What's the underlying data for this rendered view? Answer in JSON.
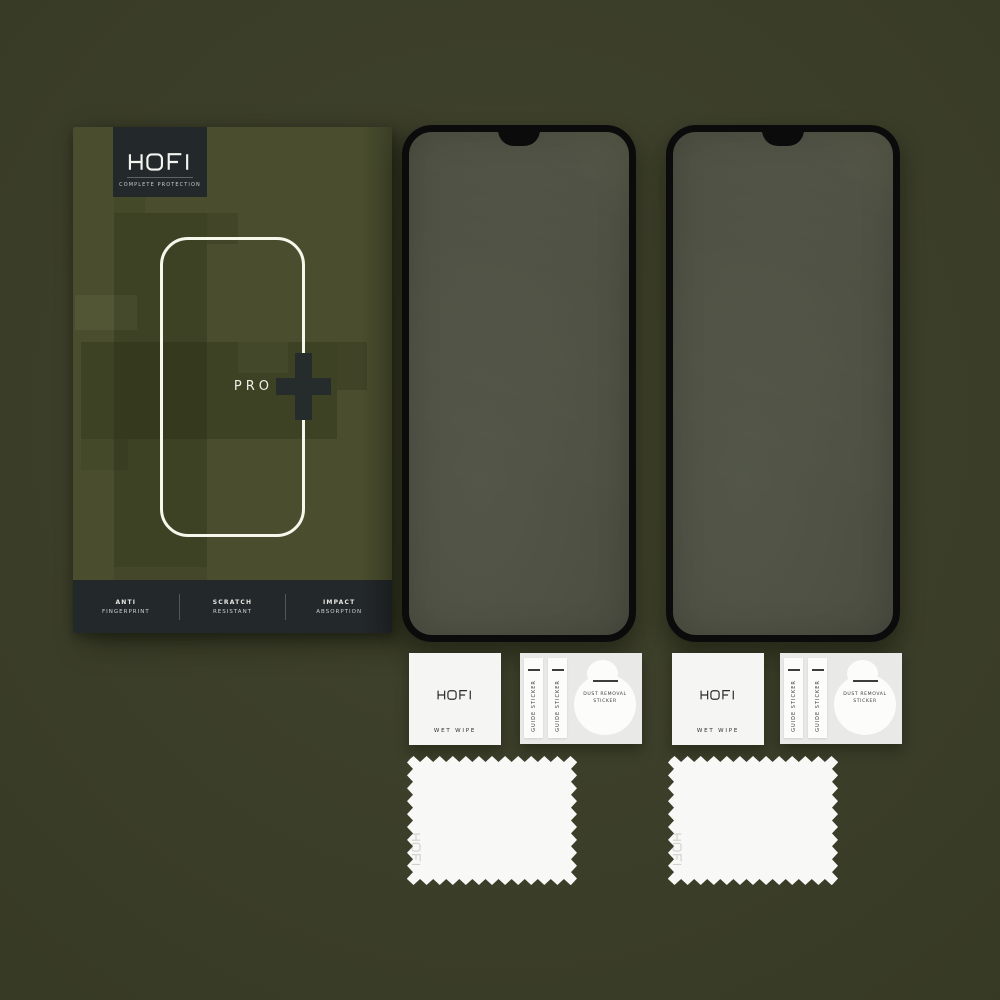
{
  "product": {
    "brand": "HOFI",
    "tagline": "COMPLETE PROTECTION",
    "model": "PRO",
    "features": [
      {
        "line1": "ANTI",
        "line2": "FINGERPRINT"
      },
      {
        "line1": "SCRATCH",
        "line2": "RESISTANT"
      },
      {
        "line1": "IMPACT",
        "line2": "ABSORPTION"
      }
    ]
  },
  "accessories": {
    "wet_wipe": {
      "brand": "HOFI",
      "label": "WET WIPE"
    },
    "guide_sticker": {
      "label": "GUIDE STICKER"
    },
    "dust_removal": {
      "line1": "DUST REMOVAL",
      "line2": "STICKER"
    },
    "cloth": {
      "brand": "HOFI"
    }
  },
  "colors": {
    "bg_light": "#41432d",
    "bg_mid": "#3a3d28",
    "bg_dark": "#31341f",
    "box": "#4a4e2e",
    "plate": "#23282a",
    "outline_white": "#f7f8ec",
    "plus_dark": "#262b2c",
    "glass_border": "#0b0b0c"
  }
}
